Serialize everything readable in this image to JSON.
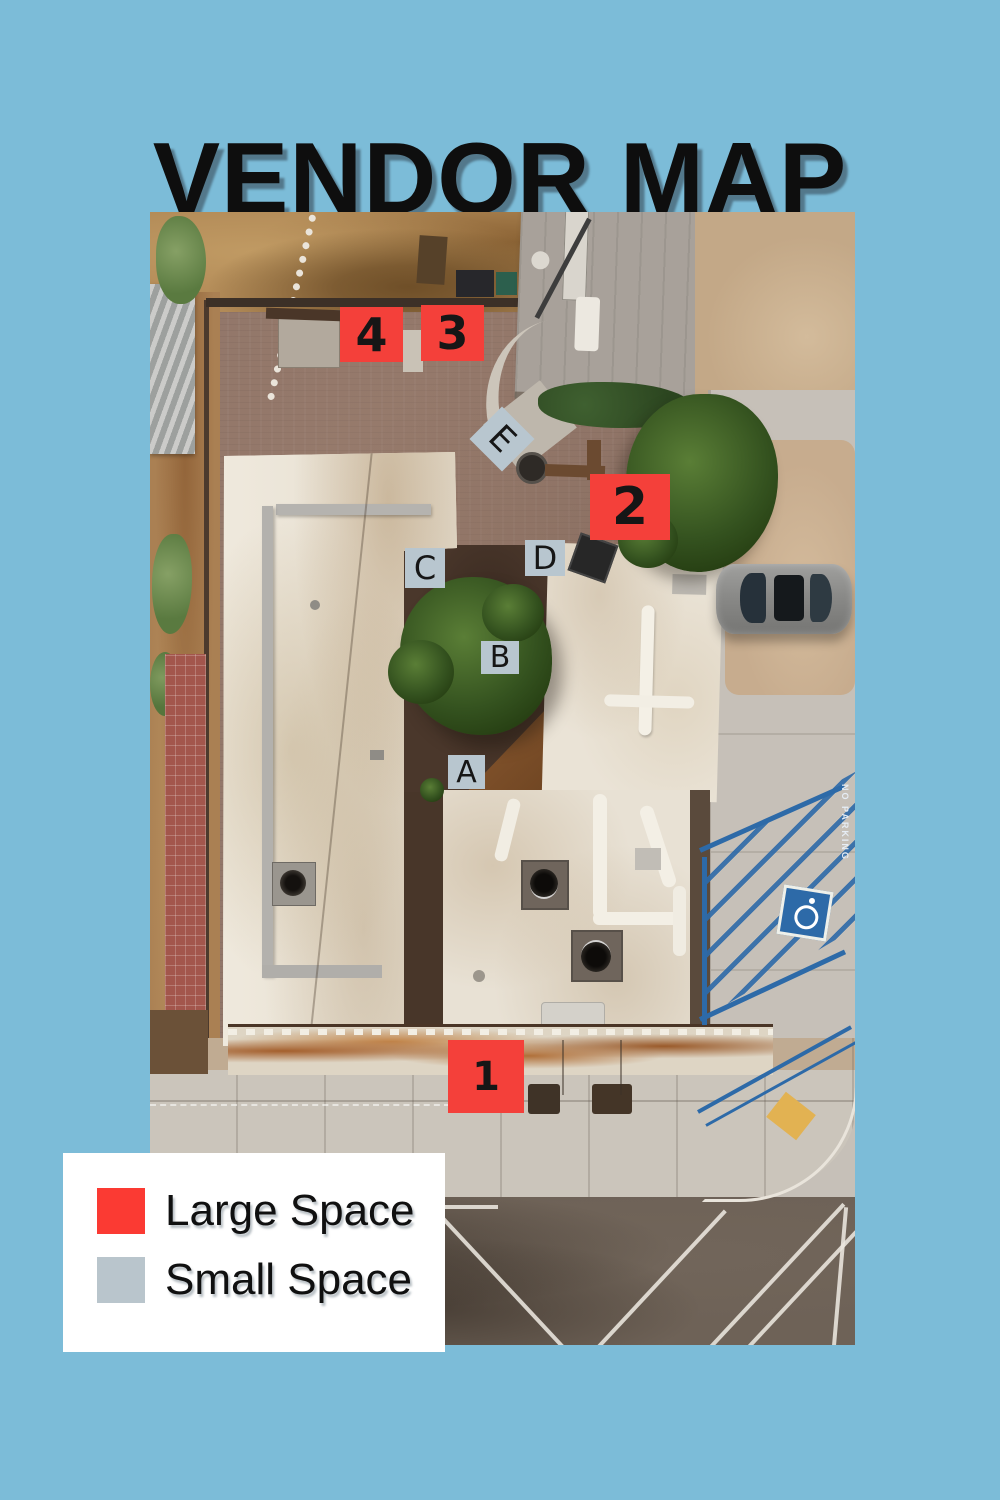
{
  "page": {
    "title": "VENDOR MAP",
    "background_color": "#7cbcd8"
  },
  "map_markers": {
    "large_color": "#f4403a",
    "small_color": "#b8c6cf",
    "large_spaces": [
      {
        "label": "1"
      },
      {
        "label": "2"
      },
      {
        "label": "3"
      },
      {
        "label": "4"
      }
    ],
    "small_spaces": [
      {
        "label": "A"
      },
      {
        "label": "B"
      },
      {
        "label": "C"
      },
      {
        "label": "D"
      },
      {
        "label": "E"
      }
    ]
  },
  "legend": {
    "items": [
      {
        "label": "Large Space",
        "color": "#fb3a33"
      },
      {
        "label": "Small Space",
        "color": "#b9c5cc"
      }
    ]
  },
  "photo": {
    "road_text": "NO PARKING"
  }
}
